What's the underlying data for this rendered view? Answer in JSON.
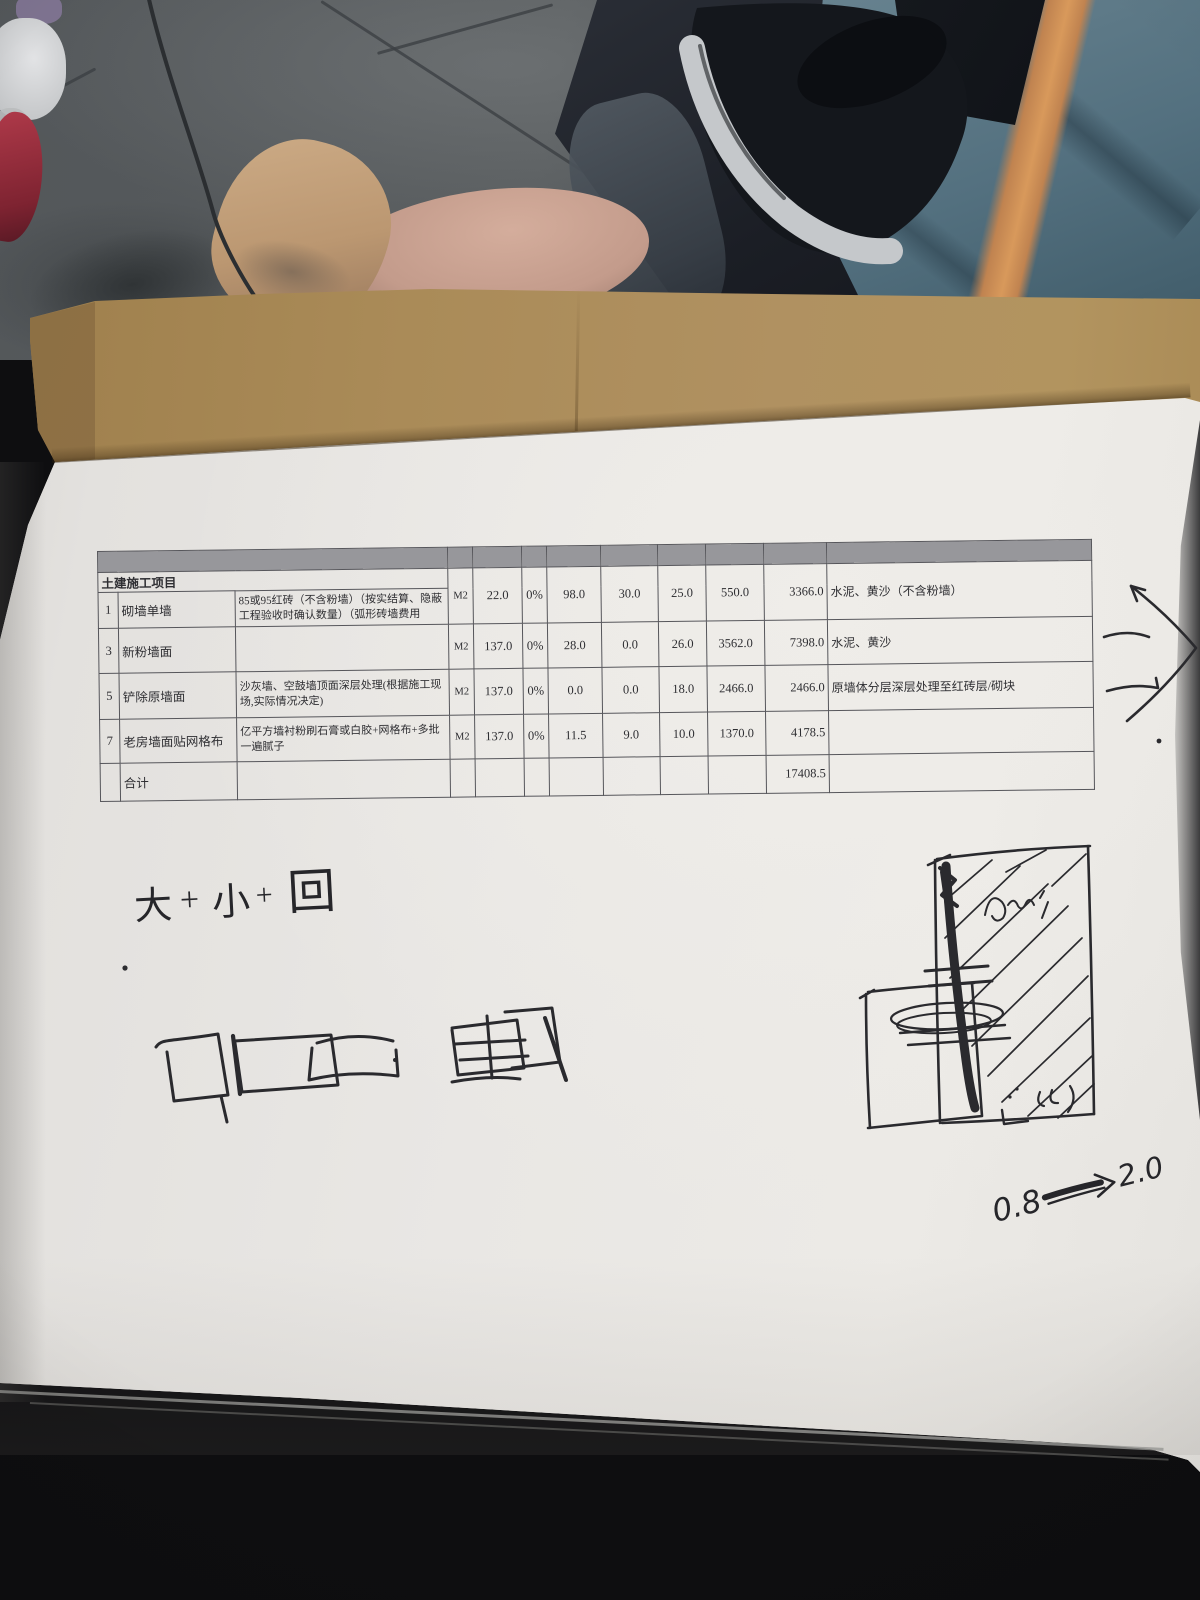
{
  "photo": {
    "paper_color": "#e9e7e4",
    "cardboard_color": "#aa8b58",
    "cloth_blue": "#53707f",
    "stripe_orange": "#d8995b",
    "ink_color": "#26262a"
  },
  "table": {
    "section_header": "土建施工项目",
    "rows": [
      {
        "num": "1",
        "name": "砌墙单墙",
        "desc": "85或95红砖（不含粉墙）（按实结算、隐蔽工程验收时确认数量）（弧形砖墙费用",
        "unit": "M2",
        "qty": "22.0",
        "loss": "0%",
        "v1": "98.0",
        "v2": "30.0",
        "v3": "25.0",
        "v4": "550.0",
        "total": "3366.0",
        "note": "水泥、黄沙（不含粉墙）"
      },
      {
        "num": "3",
        "name": "新粉墙面",
        "desc": "",
        "unit": "M2",
        "qty": "137.0",
        "loss": "0%",
        "v1": "28.0",
        "v2": "0.0",
        "v3": "26.0",
        "v4": "3562.0",
        "total": "7398.0",
        "note": "水泥、黄沙"
      },
      {
        "num": "5",
        "name": "铲除原墙面",
        "desc": "沙灰墙、空鼓墙顶面深层处理(根据施工现场,实际情况决定)",
        "unit": "M2",
        "qty": "137.0",
        "loss": "0%",
        "v1": "0.0",
        "v2": "0.0",
        "v3": "18.0",
        "v4": "2466.0",
        "total": "2466.0",
        "note": "原墙体分层深层处理至红砖层/砌块"
      },
      {
        "num": "7",
        "name": "老房墙面贴网格布",
        "desc": "亿平方墙衬粉刷石膏或白胶+网格布+多批一遍腻子",
        "unit": "M2",
        "qty": "137.0",
        "loss": "0%",
        "v1": "11.5",
        "v2": "9.0",
        "v3": "10.0",
        "v4": "1370.0",
        "total": "4178.5",
        "note": ""
      }
    ],
    "footer": {
      "label": "合计",
      "grand_total": "17408.5"
    }
  },
  "handwriting": {
    "formula": {
      "c1": "大",
      "c2": "+",
      "c3": "小",
      "c4": "+",
      "c5": "回"
    },
    "flow_from": "0.8",
    "flow_to": "2.0"
  }
}
